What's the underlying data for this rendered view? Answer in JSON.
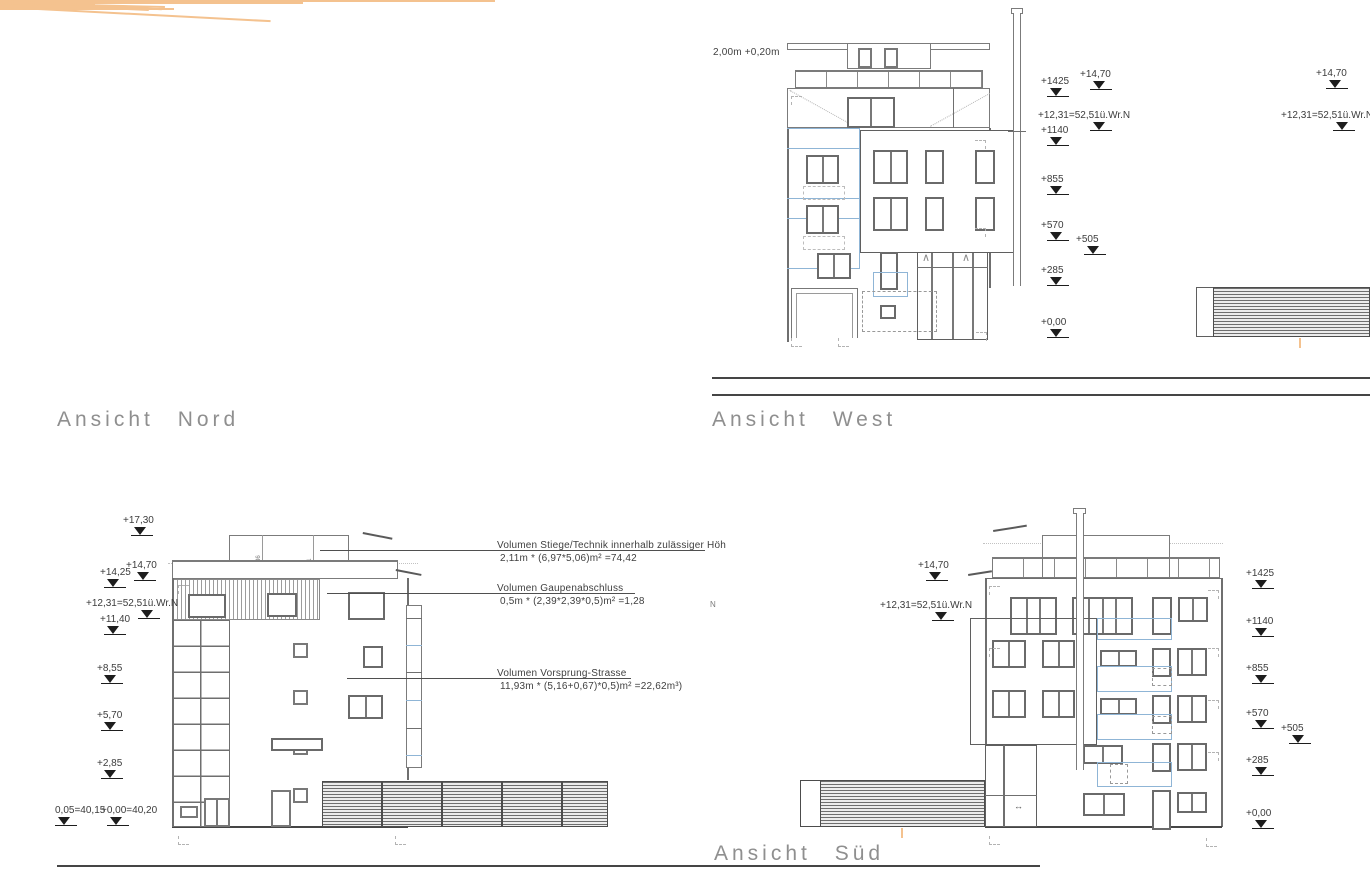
{
  "labels": {
    "nord": "Ansicht Nord",
    "west": "Ansicht West",
    "sued": "Ansicht Süd"
  },
  "notes": {
    "west_roof": "2,00m  +0,20m",
    "stray": "N"
  },
  "annotations": {
    "a1_title": "Volumen  Stiege/Technik  innerhalb  zulässiger  Höh",
    "a1_formula": "2,11m  *  (6,97*5,06)m²  =74,42",
    "a2_title": "Volumen  Gaupenabschluss",
    "a2_formula": "0,5m  *  (2,39*2,39*0,5)m²  =1,28",
    "a3_title": "Volumen  Vorsprung-Strasse",
    "a3_formula": "11,93m  *  (5,16+0,67)*0,5)m²  =22,62m³)"
  },
  "roof_dims": {
    "d1": "36",
    "d2": "211"
  },
  "door_arrow": "↔",
  "brace": "∧",
  "colors": {
    "outline": "#7b7b7b",
    "window_frame": "#787878",
    "dark_line": "#454545",
    "terrain": "#f4c28f",
    "balcony_blue": "#8fb5d6",
    "label_gray": "#8f8f8f",
    "marker_black": "#1d1d1d"
  },
  "markers": {
    "west_left": [
      {
        "label": "+1425",
        "x": 1041,
        "y": 77,
        "fx": 6
      },
      {
        "label": "+14,70",
        "x": 1080,
        "y": 70,
        "fx": 10
      },
      {
        "label": "+12,31=52,51ü.Wr.N",
        "x": 1038,
        "y": 111,
        "fx": 52
      },
      {
        "label": "+1140",
        "x": 1041,
        "y": 126,
        "fx": 6
      },
      {
        "label": "+855",
        "x": 1041,
        "y": 175,
        "fx": 6
      },
      {
        "label": "+570",
        "x": 1041,
        "y": 221,
        "fx": 6
      },
      {
        "label": "+505",
        "x": 1076,
        "y": 235,
        "fx": 8
      },
      {
        "label": "+285",
        "x": 1041,
        "y": 266,
        "fx": 6
      },
      {
        "label": "+0,00",
        "x": 1041,
        "y": 318,
        "fx": 6
      }
    ],
    "west_right": [
      {
        "label": "+14,70",
        "x": 1316,
        "y": 69,
        "fx": 10
      },
      {
        "label": "+12,31=52,51ü.Wr.N",
        "x": 1281,
        "y": 111,
        "fx": 52
      }
    ],
    "nord_ost_left": [
      {
        "label": "+17,30",
        "x": 123,
        "y": 516,
        "fx": 8
      },
      {
        "label": "+14,70",
        "x": 126,
        "y": 561,
        "fx": 8
      },
      {
        "label": "+14,25",
        "x": 100,
        "y": 568,
        "fx": 4
      },
      {
        "label": "+12,31=52,51ü.Wr.N",
        "x": 86,
        "y": 599,
        "fx": 52
      },
      {
        "label": "+11,40",
        "x": 100,
        "y": 615,
        "fx": 4
      },
      {
        "label": "+8,55",
        "x": 97,
        "y": 664,
        "fx": 4
      },
      {
        "label": "+5,70",
        "x": 97,
        "y": 711,
        "fx": 4
      },
      {
        "label": "+2,85",
        "x": 97,
        "y": 759,
        "fx": 4
      },
      {
        "label": "0,05=40,15",
        "x": 55,
        "y": 806,
        "fx": 0
      },
      {
        "label": "+0,00=40,20",
        "x": 101,
        "y": 806,
        "fx": 6
      }
    ],
    "sued_left": [
      {
        "label": "+14,70",
        "x": 918,
        "y": 561,
        "fx": 8
      },
      {
        "label": "+12,31=52,51ü.Wr.N",
        "x": 880,
        "y": 601,
        "fx": 52
      }
    ],
    "sued_right": [
      {
        "label": "+1425",
        "x": 1246,
        "y": 569,
        "fx": 6
      },
      {
        "label": "+1140",
        "x": 1246,
        "y": 617,
        "fx": 6
      },
      {
        "label": "+855",
        "x": 1246,
        "y": 664,
        "fx": 6
      },
      {
        "label": "+570",
        "x": 1246,
        "y": 709,
        "fx": 6
      },
      {
        "label": "+505",
        "x": 1281,
        "y": 724,
        "fx": 8
      },
      {
        "label": "+285",
        "x": 1246,
        "y": 756,
        "fx": 6
      },
      {
        "label": "+0,00",
        "x": 1246,
        "y": 809,
        "fx": 6
      }
    ]
  }
}
